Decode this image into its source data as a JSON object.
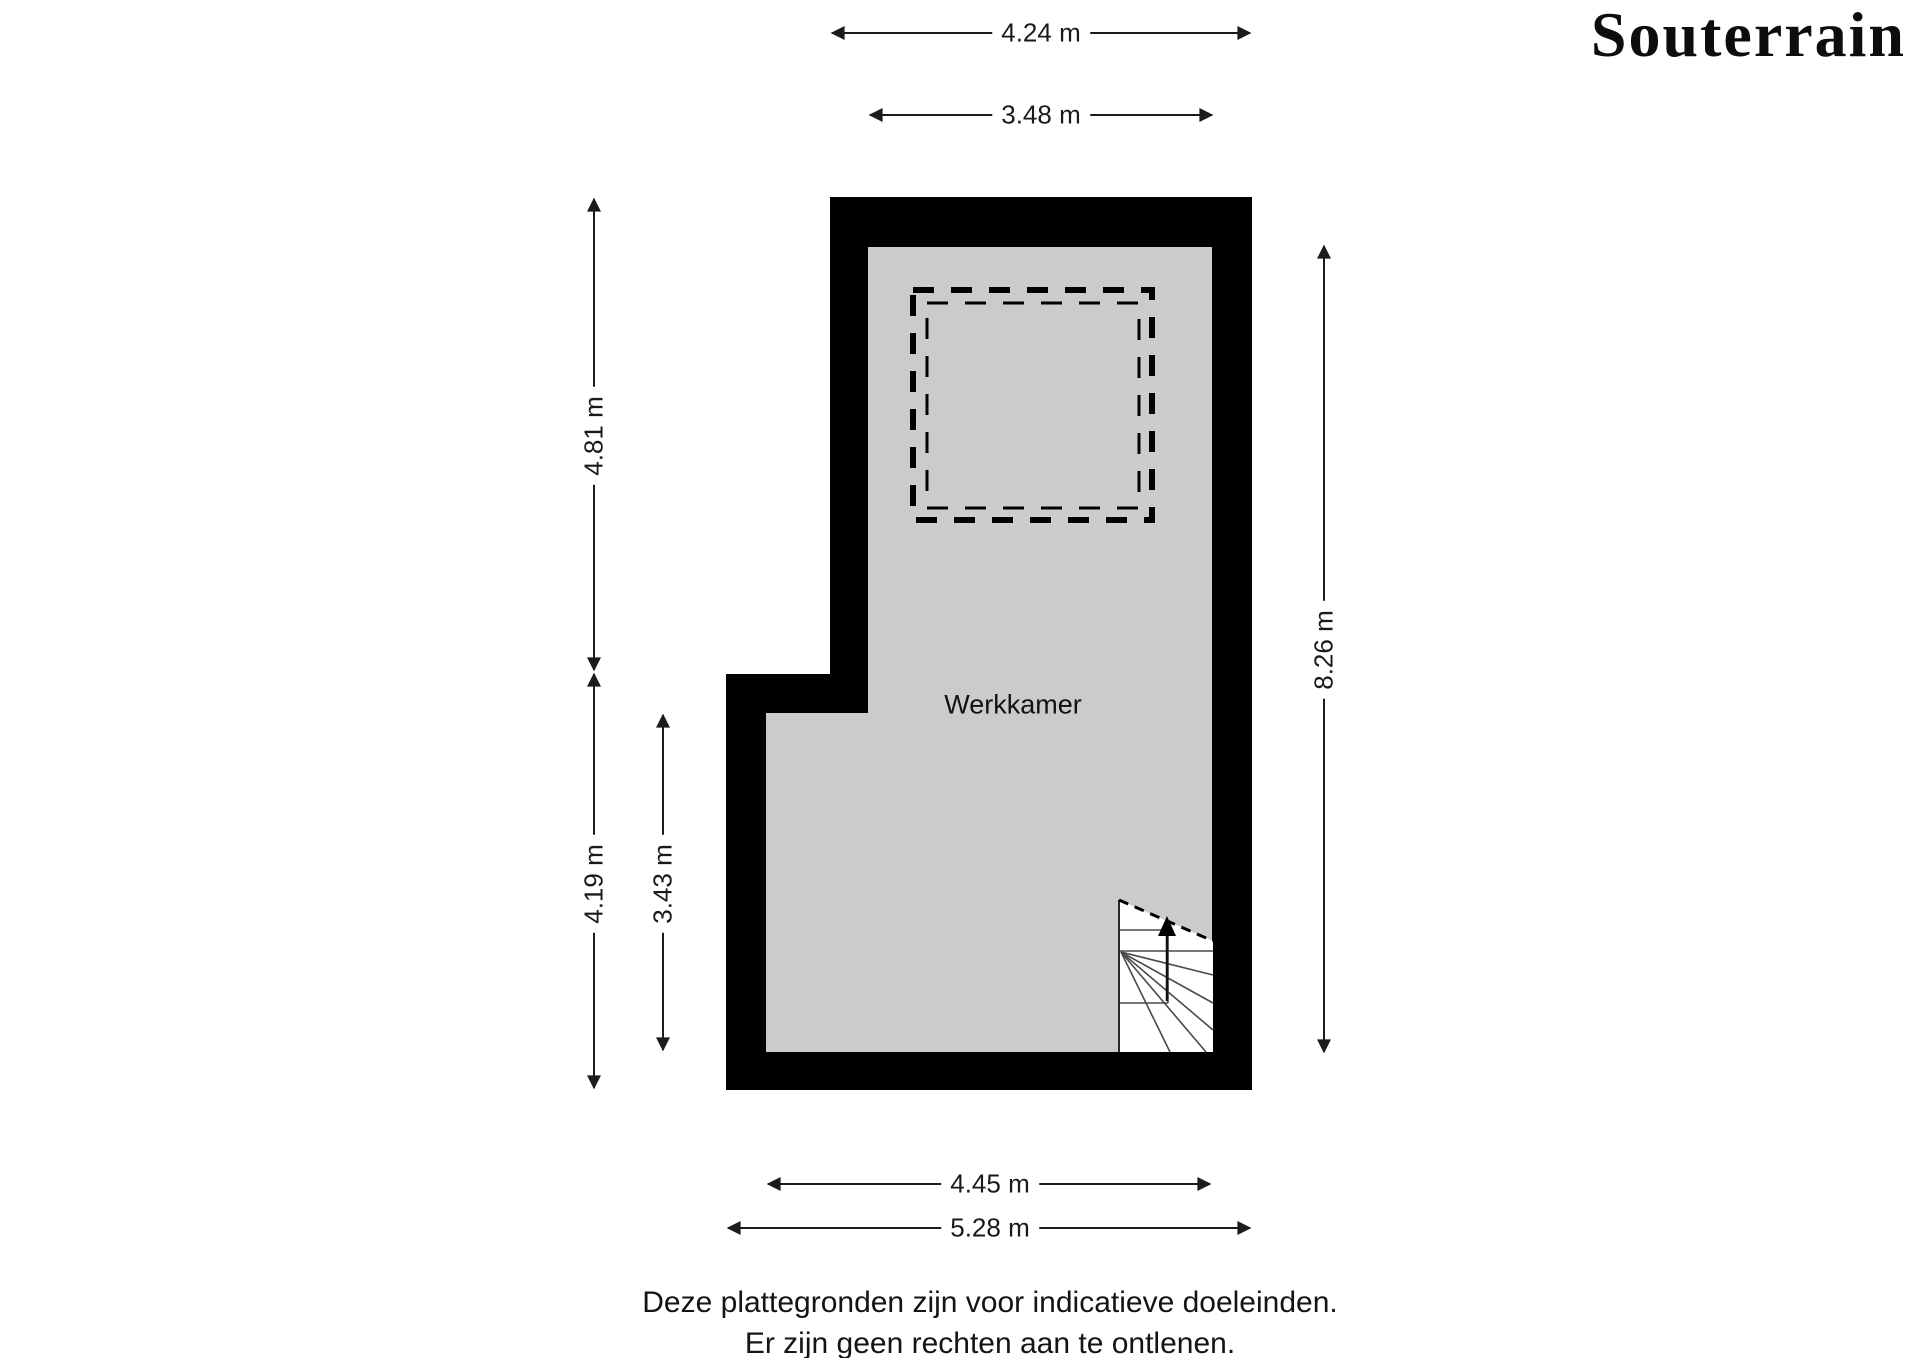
{
  "title": "Souterrain",
  "floorplan": {
    "room_label": "Werkkamer",
    "dimensions": {
      "top_outer_width": "4.24 m",
      "top_inner_width": "3.48 m",
      "left_upper_height": "4.81 m",
      "left_lower_height": "4.19 m",
      "left_lower_inner_height": "3.43 m",
      "right_height": "8.26 m",
      "bottom_inner_width": "4.45 m",
      "bottom_outer_width": "5.28 m"
    },
    "features": {
      "stairs_icon": "staircase-with-up-arrow",
      "void_icon": "dashed-opening-square"
    },
    "colors": {
      "wall": "#000000",
      "floor": "#cbcbcb",
      "background": "#ffffff",
      "line": "#1c1c1c"
    }
  },
  "disclaimer": {
    "line1": "Deze plattegronden zijn voor indicatieve doeleinden.",
    "line2": "Er zijn geen rechten aan te ontlenen."
  }
}
